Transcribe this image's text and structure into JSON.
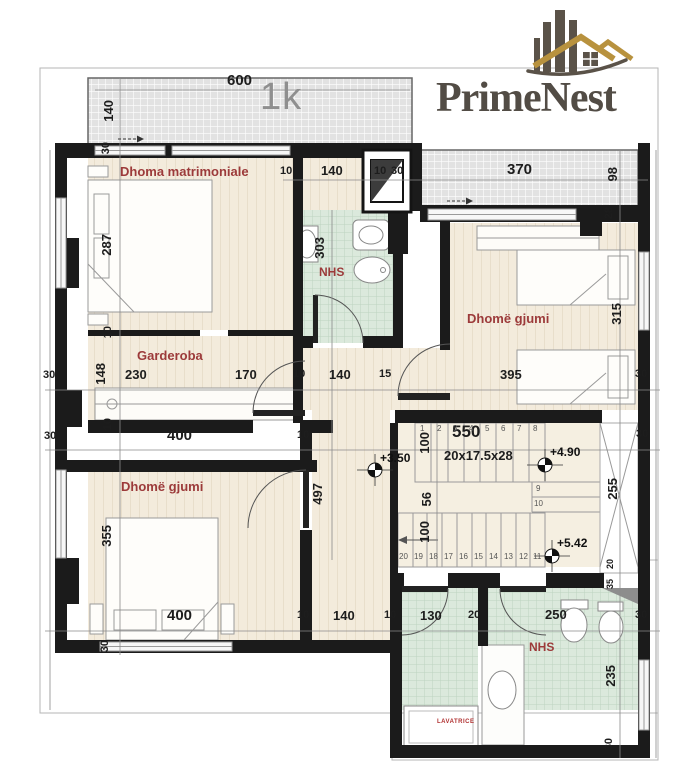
{
  "brand": {
    "name": "PrimeNest"
  },
  "plan": {
    "unit": "1k"
  },
  "rooms": {
    "master": "Dhoma matrimoniale",
    "wardrobe": "Garderoba",
    "bedroom_right": "Dhomë gjumi",
    "bedroom_left": "Dhomë gjumi",
    "bath_top": "NHS",
    "bath_bottom": "NHS",
    "laundry": "LAVATRICE"
  },
  "levels": {
    "hall": "+3.50",
    "mid": "+4.90",
    "top": "+5.42"
  },
  "stairs": {
    "width": "550",
    "spec": "20x17.5x28",
    "steps_top": [
      "1",
      "2",
      "3",
      "4",
      "5",
      "6",
      "7",
      "8"
    ],
    "steps_side": [
      "9",
      "10"
    ],
    "steps_bottom": [
      "20",
      "19",
      "18",
      "17",
      "16",
      "15",
      "14",
      "13",
      "12",
      "11"
    ]
  },
  "dims": {
    "top_width": "600",
    "balcony_depth": "140",
    "wall_top": "30",
    "bath_door": "10",
    "bath_width_top": "140",
    "shaft_a": "10",
    "shaft_b": "30",
    "balcony2_width": "370",
    "balcony2_depth": "98",
    "wall_right": "28",
    "master_depth": "287",
    "bath_depth": "303",
    "wall10_a": "10",
    "wall10_b": "10",
    "mid_30_left": "30",
    "wardrobe_depth": "148",
    "mid_230": "230",
    "mid_170": "170",
    "mid_10": "10",
    "mid_140": "140",
    "mid_15": "15",
    "mid_395": "395",
    "mid_30_right": "30",
    "row400_30_left": "30",
    "row400_400": "400",
    "row400_10": "10",
    "row400_30_right": "30",
    "bedroom_right_depth": "315",
    "run_100a": "100",
    "landing_56": "56",
    "run_100b": "100",
    "hall_depth": "497",
    "void_255": "255",
    "bed_left_height": "355",
    "left_30_bottom": "30",
    "bot_400": "400",
    "bot_10a": "10",
    "bot_140": "140",
    "bot_10b": "10",
    "bot_130": "130",
    "bot_20": "20",
    "bot_250": "250",
    "bot_30": "30",
    "right_20": "20",
    "right_35": "35",
    "bath_235": "235",
    "right_30_bottom": "30"
  }
}
